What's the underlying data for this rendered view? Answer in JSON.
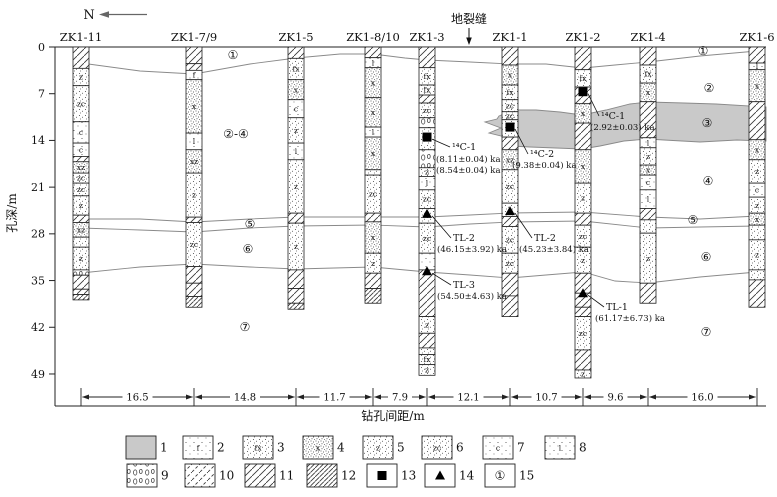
{
  "meta": {
    "north": "N",
    "fissure": "地裂缝"
  },
  "colors": {
    "zone_fill": "#c9c9c9",
    "boundary": "#8a8a8a",
    "ink": "#111111"
  },
  "axes": {
    "depth_label": "孔深/m",
    "depth_ticks": [
      "0",
      "7",
      "14",
      "21",
      "28",
      "35",
      "42",
      "49"
    ],
    "depth_values": [
      0,
      7,
      14,
      21,
      28,
      35,
      42,
      49
    ],
    "distance_label": "钻孔间距/m",
    "spacings": [
      "16.5",
      "14.8",
      "11.7",
      "7.9",
      "12.1",
      "10.7",
      "9.6",
      "16.0"
    ]
  },
  "boreholes": [
    {
      "name": "ZK1-11",
      "x": 81,
      "segments": [
        [
          "h",
          0,
          3.2,
          ""
        ],
        [
          "z",
          3.2,
          5.8,
          "z"
        ],
        [
          "zc",
          5.8,
          11.2,
          "zc"
        ],
        [
          "c",
          11.2,
          14.4,
          "c"
        ],
        [
          "c",
          14.4,
          16.4,
          "c"
        ],
        [
          "h",
          16.4,
          17.2,
          ""
        ],
        [
          "xz",
          17.2,
          18.9,
          "xz"
        ],
        [
          "zc",
          18.9,
          20.4,
          "zc"
        ],
        [
          "zc",
          20.4,
          22.3,
          "zc"
        ],
        [
          "z",
          22.3,
          25.2,
          "z"
        ],
        [
          "h",
          25.2,
          26.3,
          ""
        ],
        [
          "xz",
          26.3,
          28.5,
          "xz"
        ],
        [
          "d",
          28.5,
          30.0,
          ""
        ],
        [
          "z",
          30.0,
          33.4,
          "z"
        ],
        [
          "g",
          33.4,
          34.2,
          ""
        ],
        [
          "h",
          34.2,
          36.3,
          ""
        ],
        [
          "h",
          36.3,
          37.1,
          ""
        ],
        [
          "h3",
          37.1,
          37.9,
          ""
        ]
      ]
    },
    {
      "name": "ZK1-7/9",
      "x": 194,
      "segments": [
        [
          "h",
          0,
          2.5,
          ""
        ],
        [
          "h",
          2.5,
          3.5,
          ""
        ],
        [
          "f",
          3.5,
          4.9,
          "f"
        ],
        [
          "x",
          4.9,
          12.9,
          "x"
        ],
        [
          "l",
          12.9,
          15.4,
          "l"
        ],
        [
          "xz",
          15.4,
          18.9,
          "xz"
        ],
        [
          "z",
          18.9,
          25.5,
          "z"
        ],
        [
          "h",
          25.5,
          26.3,
          ""
        ],
        [
          "zc",
          26.3,
          32.9,
          "zc"
        ],
        [
          "h",
          32.9,
          35.4,
          ""
        ],
        [
          "h",
          35.4,
          37.4,
          ""
        ],
        [
          "h3",
          37.4,
          39.0,
          ""
        ]
      ]
    },
    {
      "name": "ZK1-5",
      "x": 296,
      "segments": [
        [
          "h",
          0,
          1.7,
          ""
        ],
        [
          "fx",
          1.7,
          4.9,
          "fx"
        ],
        [
          "x",
          4.9,
          7.9,
          "x"
        ],
        [
          "c",
          7.9,
          10.6,
          "c"
        ],
        [
          "z",
          10.6,
          14.4,
          "z"
        ],
        [
          "l",
          14.4,
          16.9,
          "l"
        ],
        [
          "z",
          16.9,
          24.9,
          "z"
        ],
        [
          "h",
          24.9,
          26.4,
          ""
        ],
        [
          "z",
          26.4,
          33.4,
          "z"
        ],
        [
          "h",
          33.4,
          36.2,
          ""
        ],
        [
          "h",
          36.2,
          38.4,
          ""
        ],
        [
          "h3",
          38.4,
          39.3,
          ""
        ]
      ]
    },
    {
      "name": "ZK1-8/10",
      "x": 373,
      "segments": [
        [
          "h",
          0,
          1.6,
          ""
        ],
        [
          "l",
          1.6,
          3.1,
          "l"
        ],
        [
          "x",
          3.1,
          7.6,
          "x"
        ],
        [
          "x",
          7.6,
          12.0,
          "x"
        ],
        [
          "l",
          12.0,
          13.5,
          "l"
        ],
        [
          "x",
          13.5,
          18.4,
          "x"
        ],
        [
          "d",
          18.4,
          19.2,
          ""
        ],
        [
          "zc",
          19.2,
          24.9,
          "zc"
        ],
        [
          "h",
          24.9,
          26.2,
          ""
        ],
        [
          "x",
          26.2,
          30.9,
          "x"
        ],
        [
          "z",
          30.9,
          33.9,
          "z"
        ],
        [
          "h",
          33.9,
          36.2,
          ""
        ],
        [
          "h3",
          36.2,
          38.4,
          ""
        ]
      ]
    },
    {
      "name": "ZK1-3",
      "x": 427,
      "segments": [
        [
          "h",
          0,
          3.1,
          ""
        ],
        [
          "fx",
          3.1,
          5.7,
          "fx"
        ],
        [
          "fx",
          5.7,
          7.2,
          "fx"
        ],
        [
          "h",
          7.2,
          8.4,
          ""
        ],
        [
          "zc",
          8.4,
          10.6,
          "zc"
        ],
        [
          "g",
          10.6,
          12.1,
          ""
        ],
        [
          "d",
          12.1,
          15.4,
          ""
        ],
        [
          "g",
          15.4,
          18.1,
          ""
        ],
        [
          "z",
          18.1,
          19.4,
          "z"
        ],
        [
          "l",
          19.4,
          21.4,
          "l"
        ],
        [
          "zc",
          21.4,
          24.2,
          "zc"
        ],
        [
          "d",
          24.2,
          26.4,
          ""
        ],
        [
          "zc",
          26.4,
          30.9,
          "zc"
        ],
        [
          "c",
          30.9,
          33.4,
          ""
        ],
        [
          "h",
          33.4,
          40.4,
          ""
        ],
        [
          "z",
          40.4,
          42.9,
          "z"
        ],
        [
          "h",
          42.9,
          45.1,
          ""
        ],
        [
          "d",
          45.1,
          46.1,
          ""
        ],
        [
          "fx",
          46.1,
          47.6,
          "fx"
        ],
        [
          "z",
          47.6,
          49.2,
          "z"
        ]
      ]
    },
    {
      "name": "ZK1-1",
      "x": 510,
      "segments": [
        [
          "h",
          0,
          2.7,
          ""
        ],
        [
          "x",
          2.7,
          5.7,
          "x"
        ],
        [
          "fx",
          5.7,
          7.9,
          "fx"
        ],
        [
          "zc",
          7.9,
          9.7,
          "zc"
        ],
        [
          "zc",
          9.7,
          10.9,
          "zc"
        ],
        [
          "d",
          10.9,
          13.5,
          ""
        ],
        [
          "h",
          13.5,
          15.4,
          ""
        ],
        [
          "xz",
          15.4,
          18.4,
          "xz"
        ],
        [
          "zc",
          18.4,
          23.4,
          "zc"
        ],
        [
          "d",
          23.4,
          25.4,
          ""
        ],
        [
          "h",
          25.4,
          26.9,
          ""
        ],
        [
          "zc",
          26.9,
          30.9,
          "zc"
        ],
        [
          "zc",
          30.9,
          33.9,
          "zc"
        ],
        [
          "h",
          33.9,
          37.3,
          ""
        ],
        [
          "h",
          37.3,
          40.4,
          ""
        ]
      ]
    },
    {
      "name": "ZK1-2",
      "x": 583,
      "segments": [
        [
          "h",
          0,
          3.4,
          ""
        ],
        [
          "fx",
          3.4,
          6.0,
          "fx"
        ],
        [
          "h",
          6.0,
          8.5,
          ""
        ],
        [
          "x",
          8.5,
          11.4,
          "x"
        ],
        [
          "h",
          11.4,
          15.4,
          ""
        ],
        [
          "x",
          15.4,
          20.4,
          "x"
        ],
        [
          "z",
          20.4,
          24.9,
          "z"
        ],
        [
          "h",
          24.9,
          26.7,
          ""
        ],
        [
          "zc",
          26.7,
          30.0,
          "zc"
        ],
        [
          "z",
          30.0,
          33.9,
          "z"
        ],
        [
          "h",
          33.9,
          36.9,
          ""
        ],
        [
          "h",
          36.9,
          39.0,
          ""
        ],
        [
          "h",
          39.0,
          40.4,
          ""
        ],
        [
          "zc",
          40.4,
          45.4,
          "zc"
        ],
        [
          "h",
          45.4,
          48.4,
          ""
        ],
        [
          "z",
          48.4,
          49.6,
          "z"
        ]
      ]
    },
    {
      "name": "ZK1-4",
      "x": 648,
      "segments": [
        [
          "h",
          0,
          2.7,
          ""
        ],
        [
          "fx",
          2.7,
          5.4,
          "fx"
        ],
        [
          "x",
          5.4,
          8.2,
          "x"
        ],
        [
          "h",
          8.2,
          13.6,
          ""
        ],
        [
          "l",
          13.6,
          15.1,
          "l"
        ],
        [
          "z",
          15.1,
          17.7,
          "z"
        ],
        [
          "xz",
          17.7,
          19.2,
          "x"
        ],
        [
          "c",
          19.2,
          21.4,
          "c"
        ],
        [
          "l",
          21.4,
          24.2,
          "l"
        ],
        [
          "h",
          24.2,
          25.9,
          ""
        ],
        [
          "d",
          25.9,
          27.9,
          ""
        ],
        [
          "z",
          27.9,
          35.4,
          "z"
        ],
        [
          "h",
          35.4,
          38.4,
          ""
        ]
      ]
    },
    {
      "name": "ZK1-6",
      "x": 757,
      "segments": [
        [
          "h",
          0,
          2.4,
          ""
        ],
        [
          "l",
          2.4,
          3.4,
          "l"
        ],
        [
          "x",
          3.4,
          8.2,
          "x"
        ],
        [
          "h",
          8.2,
          13.9,
          ""
        ],
        [
          "x",
          13.9,
          16.9,
          "x"
        ],
        [
          "z",
          16.9,
          20.4,
          "z"
        ],
        [
          "c",
          20.4,
          22.5,
          "c"
        ],
        [
          "z",
          22.5,
          24.9,
          "z"
        ],
        [
          "xz",
          24.9,
          26.7,
          "x"
        ],
        [
          "d",
          26.7,
          28.9,
          ""
        ],
        [
          "z",
          28.9,
          33.4,
          "z"
        ],
        [
          "d",
          33.4,
          34.9,
          ""
        ],
        [
          "h",
          34.9,
          39.0,
          ""
        ]
      ]
    }
  ],
  "fissure_zone": {
    "points": [
      [
        499,
        116
      ],
      [
        513,
        110
      ],
      [
        536,
        110
      ],
      [
        560,
        112
      ],
      [
        582,
        115
      ],
      [
        606,
        110
      ],
      [
        630,
        104
      ],
      [
        648,
        102
      ],
      [
        684,
        103
      ],
      [
        716,
        104
      ],
      [
        766,
        107
      ],
      [
        766,
        141
      ],
      [
        737,
        140
      ],
      [
        700,
        142
      ],
      [
        664,
        140
      ],
      [
        648,
        139
      ],
      [
        624,
        141
      ],
      [
        600,
        146
      ],
      [
        582,
        149
      ],
      [
        556,
        148
      ],
      [
        530,
        147
      ],
      [
        511,
        146
      ],
      [
        503,
        143
      ],
      [
        509,
        138
      ],
      [
        489,
        133
      ],
      [
        501,
        128
      ],
      [
        485,
        122
      ],
      [
        497,
        119
      ]
    ]
  },
  "boundaries": [
    [
      [
        81,
        63
      ],
      [
        140,
        71
      ],
      [
        194,
        74
      ],
      [
        250,
        64
      ],
      [
        296,
        58
      ],
      [
        340,
        54
      ],
      [
        373,
        54
      ],
      [
        405,
        58
      ],
      [
        427,
        60
      ],
      [
        470,
        62
      ],
      [
        510,
        64
      ],
      [
        546,
        64
      ],
      [
        583,
        68
      ],
      [
        615,
        65
      ],
      [
        648,
        62
      ],
      [
        700,
        56
      ],
      [
        757,
        51
      ]
    ],
    [
      [
        81,
        219
      ],
      [
        140,
        219
      ],
      [
        194,
        222
      ],
      [
        250,
        219
      ],
      [
        296,
        217
      ],
      [
        373,
        217
      ],
      [
        427,
        217
      ],
      [
        470,
        215
      ],
      [
        510,
        213
      ],
      [
        583,
        212
      ],
      [
        648,
        217
      ],
      [
        700,
        219
      ],
      [
        757,
        216
      ]
    ],
    [
      [
        81,
        228
      ],
      [
        140,
        230
      ],
      [
        194,
        232
      ],
      [
        250,
        228
      ],
      [
        296,
        226
      ],
      [
        373,
        225
      ],
      [
        427,
        227
      ],
      [
        470,
        224
      ],
      [
        510,
        222
      ],
      [
        583,
        221
      ],
      [
        648,
        228
      ],
      [
        700,
        227
      ],
      [
        757,
        226
      ]
    ],
    [
      [
        81,
        273
      ],
      [
        140,
        267
      ],
      [
        194,
        264
      ],
      [
        250,
        267
      ],
      [
        296,
        269
      ],
      [
        373,
        267
      ],
      [
        427,
        272
      ],
      [
        470,
        275
      ],
      [
        510,
        278
      ],
      [
        546,
        275
      ],
      [
        583,
        272
      ],
      [
        615,
        281
      ],
      [
        648,
        283
      ],
      [
        700,
        277
      ],
      [
        757,
        272
      ]
    ]
  ],
  "strata_labels": [
    {
      "text": "①",
      "x": 233,
      "y": 59
    },
    {
      "text": "①",
      "x": 703,
      "y": 55
    },
    {
      "text": "②-④",
      "x": 236,
      "y": 138
    },
    {
      "text": "②",
      "x": 709,
      "y": 92
    },
    {
      "text": "③",
      "x": 707,
      "y": 127
    },
    {
      "text": "④",
      "x": 708,
      "y": 185
    },
    {
      "text": "⑤",
      "x": 250,
      "y": 228
    },
    {
      "text": "⑤",
      "x": 693,
      "y": 224
    },
    {
      "text": "⑥",
      "x": 248,
      "y": 253
    },
    {
      "text": "⑥",
      "x": 706,
      "y": 261
    },
    {
      "text": "⑦",
      "x": 245,
      "y": 331
    },
    {
      "text": "⑦",
      "x": 706,
      "y": 336
    }
  ],
  "samples": [
    {
      "marker": "square",
      "name": "¹⁴C-1",
      "ages": [
        "(8.11±0.04) ka",
        "(8.54±0.04) ka"
      ],
      "col_x": 427,
      "depth": 13.5,
      "name_x": 452,
      "name_y": 150,
      "ages_x": 436,
      "ages_y": 162
    },
    {
      "marker": "square",
      "name": "¹⁴C-2",
      "ages": [
        "(9.38±0.04) ka"
      ],
      "col_x": 510,
      "depth": 12.0,
      "name_x": 530,
      "name_y": 157,
      "ages_x": 512,
      "ages_y": 168
    },
    {
      "marker": "square",
      "name": "¹⁴C-1",
      "ages": [
        "(2.92±0.03) ka"
      ],
      "col_x": 583,
      "depth": 6.7,
      "name_x": 601,
      "name_y": 119,
      "ages_x": 590,
      "ages_y": 130
    },
    {
      "marker": "triangle",
      "name": "TL-2",
      "ages": [
        "(46.15±3.92) ka"
      ],
      "col_x": 427,
      "depth": 25.0,
      "name_x": 453,
      "name_y": 241,
      "ages_x": 437,
      "ages_y": 252
    },
    {
      "marker": "triangle",
      "name": "TL-2",
      "ages": [
        "(45.23±3.84) ka"
      ],
      "col_x": 510,
      "depth": 24.6,
      "name_x": 534,
      "name_y": 241,
      "ages_x": 519,
      "ages_y": 252
    },
    {
      "marker": "triangle",
      "name": "TL-3",
      "ages": [
        "(54.50±4.63) ka"
      ],
      "col_x": 427,
      "depth": 33.6,
      "name_x": 453,
      "name_y": 288,
      "ages_x": 437,
      "ages_y": 299
    },
    {
      "marker": "triangle",
      "name": "TL-1",
      "ages": [
        "(61.17±6.73) ka"
      ],
      "col_x": 583,
      "depth": 36.9,
      "name_x": 606,
      "name_y": 310,
      "ages_x": 595,
      "ages_y": 321
    }
  ],
  "legend": [
    {
      "n": "1",
      "p": "gray",
      "code": "",
      "x": 126,
      "y": 436
    },
    {
      "n": "2",
      "p": "dots1",
      "code": "f",
      "x": 183,
      "y": 436
    },
    {
      "n": "3",
      "p": "dots2",
      "code": "fx",
      "x": 243,
      "y": 436
    },
    {
      "n": "4",
      "p": "dots3",
      "code": "x",
      "x": 303,
      "y": 436
    },
    {
      "n": "5",
      "p": "dots2",
      "code": "z",
      "x": 363,
      "y": 436
    },
    {
      "n": "6",
      "p": "dots2",
      "code": "zc",
      "x": 422,
      "y": 436
    },
    {
      "n": "7",
      "p": "dots1",
      "code": "c",
      "x": 483,
      "y": 436
    },
    {
      "n": "8",
      "p": "dots1",
      "code": "l",
      "x": 545,
      "y": 436
    },
    {
      "n": "9",
      "p": "grav",
      "code": "",
      "x": 127,
      "y": 464
    },
    {
      "n": "10",
      "p": "hd",
      "code": "",
      "x": 185,
      "y": 464
    },
    {
      "n": "11",
      "p": "h",
      "code": "",
      "x": 245,
      "y": 464
    },
    {
      "n": "12",
      "p": "h3",
      "code": "",
      "x": 307,
      "y": 464
    },
    {
      "n": "13",
      "p": "sq",
      "code": "",
      "x": 367,
      "y": 464
    },
    {
      "n": "14",
      "p": "tri",
      "code": "",
      "x": 425,
      "y": 464
    },
    {
      "n": "15",
      "p": "circ",
      "code": "①",
      "x": 485,
      "y": 464
    }
  ]
}
